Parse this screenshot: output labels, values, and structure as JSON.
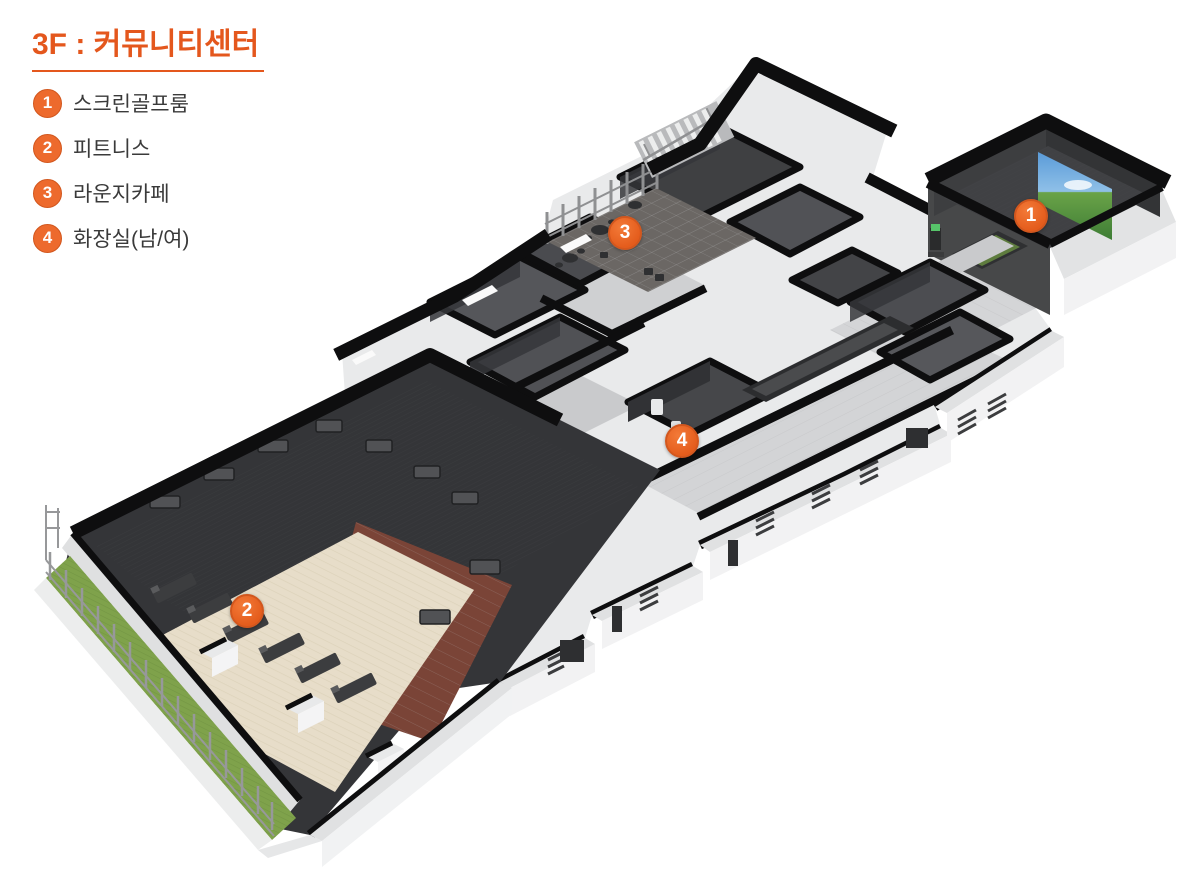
{
  "page": {
    "background": "#ffffff",
    "type": "isometric-floorplan"
  },
  "header": {
    "title": "3F : 커뮤니티센터"
  },
  "legend": {
    "items": [
      {
        "number": "1",
        "label": "스크린골프룸"
      },
      {
        "number": "2",
        "label": "피트니스"
      },
      {
        "number": "3",
        "label": "라운지카페"
      },
      {
        "number": "4",
        "label": "화장실(남/여)"
      }
    ]
  },
  "floorplan": {
    "description": "3D isometric cutaway plan of the 3rd floor community center",
    "markers": [
      {
        "number": "1",
        "room": "스크린골프룸",
        "x": 1031,
        "y": 216
      },
      {
        "number": "2",
        "room": "피트니스",
        "x": 247,
        "y": 611
      },
      {
        "number": "3",
        "label": "라운지카페",
        "room": "라운지카페",
        "x": 625,
        "y": 233
      },
      {
        "number": "4",
        "room": "화장실(남/여)",
        "x": 682,
        "y": 441
      }
    ]
  },
  "palette": {
    "accent_orange": "#e4571d",
    "marker_orange": "#ed6a2d",
    "text_dark": "#3a3a3a",
    "wall_black": "#0e0e0f",
    "wall_white": "#f2f2f3",
    "floor_tile": "#d3d4d6",
    "floor_dark": "#3a3b3e",
    "floor_wood": "#e7ddc9",
    "floor_brown": "#7a4437",
    "grass_green": "#7fa24b",
    "screen_sky": "#5a9bd8",
    "screen_grass": "#4c8340"
  }
}
